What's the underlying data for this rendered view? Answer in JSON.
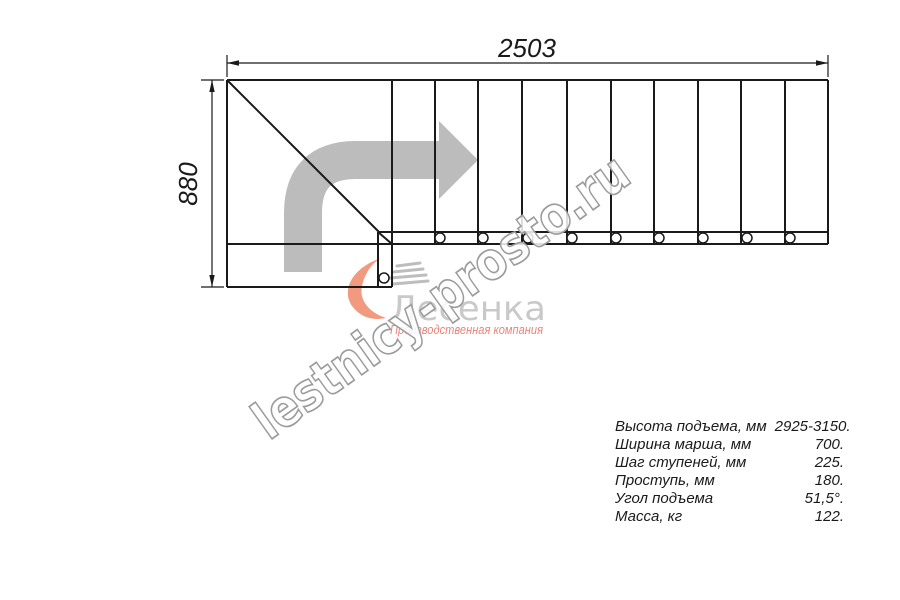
{
  "dimensions": {
    "width_mm": "2503",
    "height_mm": "880"
  },
  "watermark": {
    "text": "lestnicy-prosto.ru"
  },
  "logo": {
    "name": "Лесенка",
    "tagline": "Производственная компания"
  },
  "specs": {
    "rows": [
      {
        "label": "Высота подъема, мм",
        "value": "2925-3150."
      },
      {
        "label": "Ширина марша, мм",
        "value": "700."
      },
      {
        "label": "Шаг ступеней, мм",
        "value": "225."
      },
      {
        "label": "Проступь, мм",
        "value": "180."
      },
      {
        "label": "Угол подъема",
        "value": "51,5°."
      },
      {
        "label": "Масса, кг",
        "value": "122."
      }
    ]
  },
  "colors": {
    "line": "#1a1a1a",
    "direction_arrow": "#bcbcbc",
    "watermark_outline": "#9c9c9c",
    "logo_text": "#c9c9c9",
    "logo_tagline": "#e8857b",
    "logo_swoosh": "#f29a80",
    "logo_boards": "#bdbdbd"
  }
}
